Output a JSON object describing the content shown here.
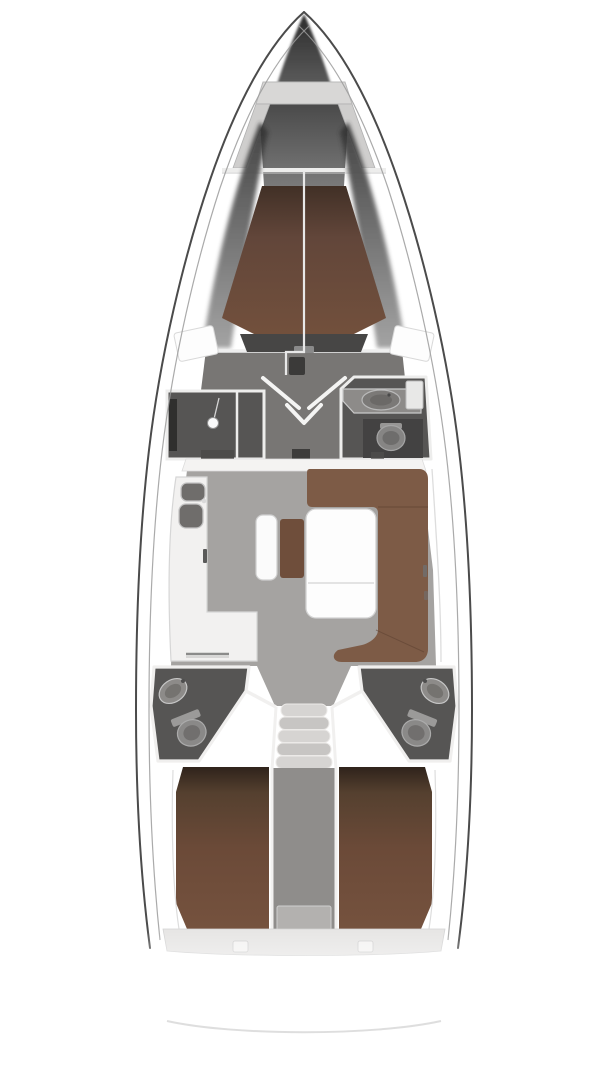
{
  "canvas": {
    "width": 608,
    "height": 1080,
    "background": "#ffffff"
  },
  "diagram": {
    "type": "yacht-interior-floor-plan",
    "orientation": "bow-up",
    "regions": [
      "anchor-locker",
      "forward-cabin-v-berth",
      "shower-compartment",
      "forward-head",
      "mast-post",
      "saloon",
      "galley",
      "dinette-table",
      "u-shaped-settee",
      "center-bench",
      "companionway-stairs",
      "aft-head-port",
      "aft-head-starboard",
      "aft-cabin-port",
      "aft-cabin-starboard",
      "engine-compartment",
      "transom"
    ],
    "colors": {
      "hull_line": "#4b4b4b",
      "hull_inner_line": "#9b9b9b",
      "deck_white": "#ffffff",
      "locker_gray": "#d8d7d6",
      "rail_gray": "#cfcecd",
      "bow_dark_top": "#2b2b2b",
      "bow_dark_bottom": "#7a7a7a",
      "bow_inner_top": "#4a4a4a",
      "bow_inner_bottom": "#7a7a7a",
      "wedge_dark": "#303030",
      "wedge_light": "#9a9a9a",
      "floor_light": "#a5a3a1",
      "floor_dark": "#787674",
      "wall_white": "#f1f0ef",
      "compartment_dark": "#565554",
      "alcove_dark": "#434242",
      "fixture_gray": "#8d8b89",
      "counter_white": "#f2f1f0",
      "sink_dark": "#6f6d6b",
      "fwd_berth_brown": "#72503c",
      "fwd_berth_shadow": "#413026",
      "aft_berth_brown": "#75523e",
      "aft_berth_shadow": "#2f231b",
      "settee_brown": "#7d5b46",
      "cushion_brown": "#6f4e3b",
      "table_white": "#fdfdfd",
      "bench_white": "#fbfbfb",
      "step_gray": "#d6d4d2",
      "step_gray_alt": "#c7c5c3",
      "engine_gray": "#8f8d8b",
      "engine_panel": "#b3b1af",
      "bulkhead_band": "#e6e5e4",
      "headboard_dark": "#474645",
      "mast_dark": "#3b3a39",
      "stern_line": "#d8d8d8"
    }
  }
}
